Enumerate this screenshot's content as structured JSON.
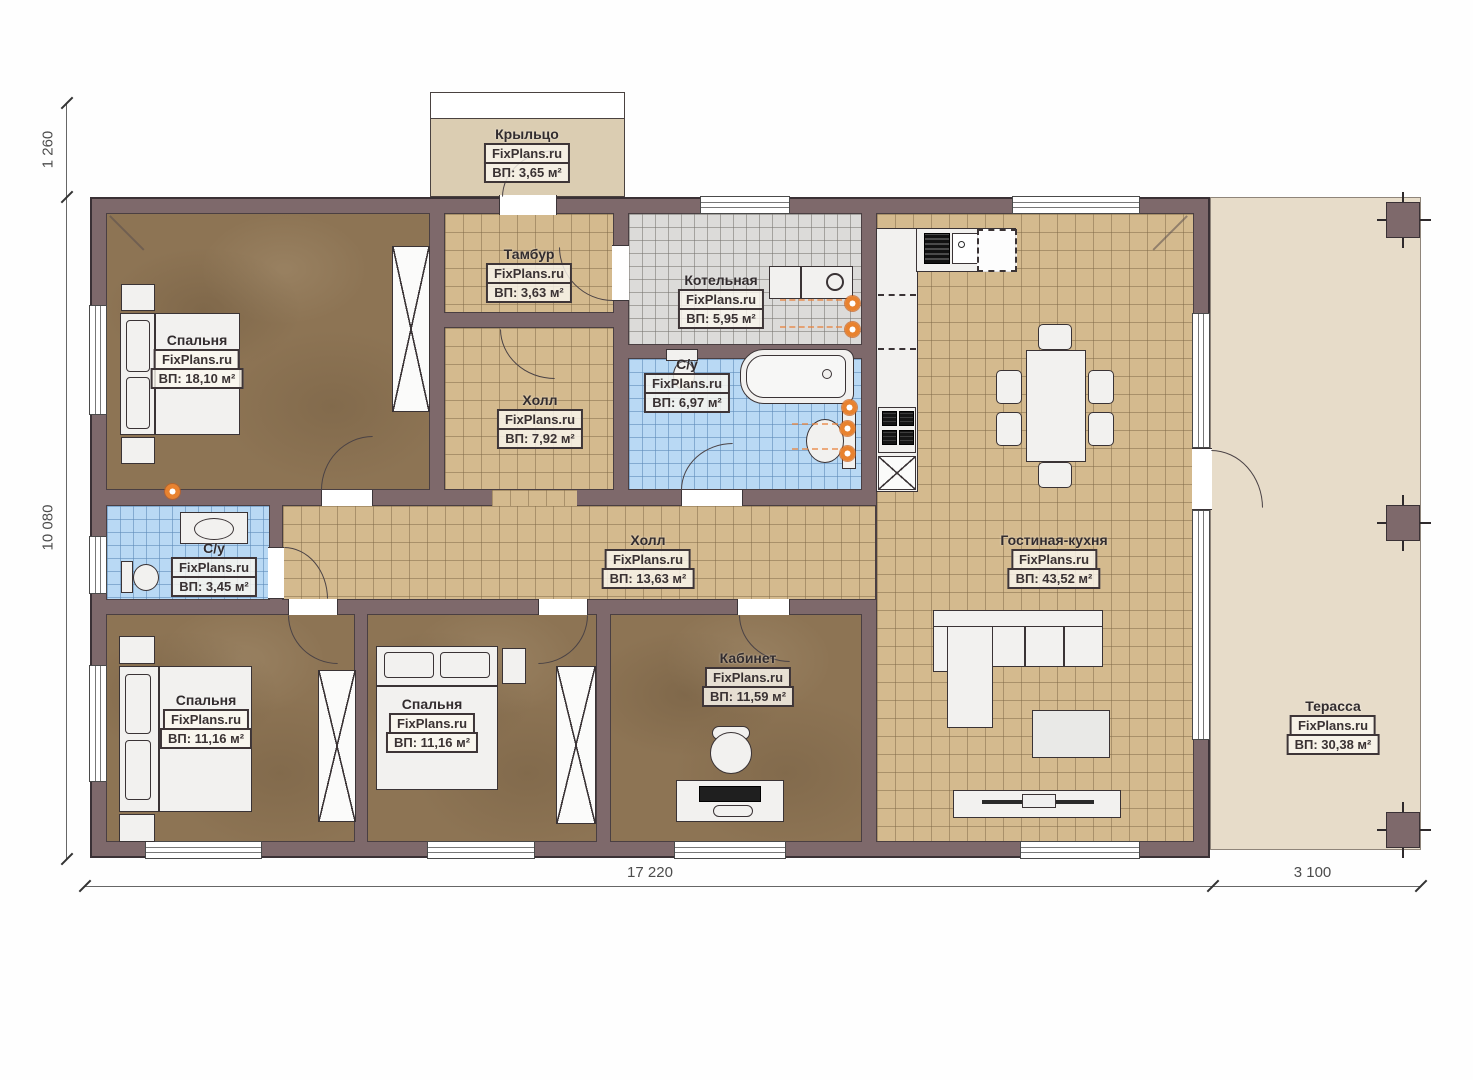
{
  "brand": "FixPlans.ru",
  "dimensions": {
    "porch_offset": "1 260",
    "house_depth": "10 080",
    "house_width": "17 220",
    "terrace_width": "3 100"
  },
  "rooms": {
    "porch": {
      "name": "Крыльцо",
      "brand": "FixPlans.ru",
      "area": "ВП: 3,65 м²"
    },
    "tambour": {
      "name": "Тамбур",
      "brand": "FixPlans.ru",
      "area": "ВП: 3,63 м²"
    },
    "hall_north": {
      "name": "Холл",
      "brand": "FixPlans.ru",
      "area": "ВП: 7,92 м²"
    },
    "bedroom_master": {
      "name": "Спальня",
      "brand": "FixPlans.ru",
      "area": "ВП: 18,10 м²"
    },
    "boiler": {
      "name": "Котельная",
      "brand": "FixPlans.ru",
      "area": "ВП: 5,95 м²"
    },
    "bath_main": {
      "name": "С/у",
      "brand": "FixPlans.ru",
      "area": "ВП: 6,97 м²"
    },
    "bath_small": {
      "name": "С/у",
      "brand": "FixPlans.ru",
      "area": "ВП: 3,45 м²"
    },
    "hall_central": {
      "name": "Холл",
      "brand": "FixPlans.ru",
      "area": "ВП: 13,63 м²"
    },
    "living_kitchen": {
      "name": "Гостиная-кухня",
      "brand": "FixPlans.ru",
      "area": "ВП: 43,52 м²"
    },
    "bedroom_2": {
      "name": "Спальня",
      "brand": "FixPlans.ru",
      "area": "ВП: 11,16 м²"
    },
    "bedroom_3": {
      "name": "Спальня",
      "brand": "FixPlans.ru",
      "area": "ВП: 11,16 м²"
    },
    "office": {
      "name": "Кабинет",
      "brand": "FixPlans.ru",
      "area": "ВП: 11,59 м²"
    },
    "terrace": {
      "name": "Терасса",
      "brand": "FixPlans.ru",
      "area": "ВП: 30,38 м²"
    }
  },
  "colors": {
    "wall": "#7e696b",
    "tile_beige": "#d4ba8e",
    "tile_gray": "#dcdbd9",
    "tile_blue": "#b9d9f4",
    "floor_brown": "#8d7454",
    "terrace": "#e7dcc9",
    "porch": "#dbcdb2",
    "accent_orange": "#e8822f"
  }
}
